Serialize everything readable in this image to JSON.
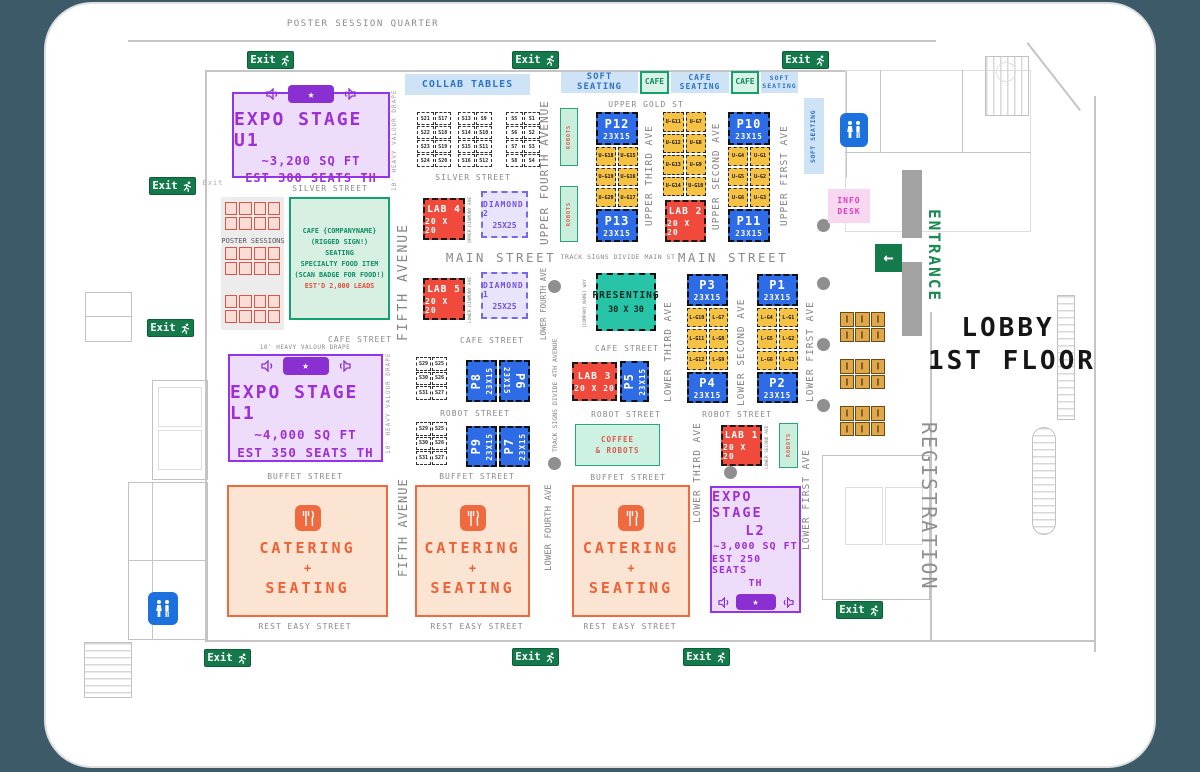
{
  "palette": {
    "page_bg": "#3c5a68",
    "stage_purple": "#9334ea",
    "booth_blue": "#2e6be6",
    "lab_red": "#ef4a3c",
    "gold_booth": "#f5c243",
    "teal": "#28c4a8",
    "exit_green": "#157a4b",
    "soft_blue": "#cfe3f6",
    "cafe_green": "#16a06c",
    "catering_orange": "#f06a40",
    "info_pink": "#f8d7f0",
    "restroom_blue": "#1d71dd"
  },
  "top": {
    "quarter": "POSTER SESSION QUARTER"
  },
  "signs": {
    "exit": "Exit",
    "exit_small": "Exit",
    "arrow_left": "←"
  },
  "zones": {
    "collab": "COLLAB TABLES",
    "soft_seating": "SOFT SEATING",
    "cafe": "CAFE",
    "cafe_seating": "CAFE SEATING",
    "soft_seating_vertical": "SOFT SEATING",
    "poster_sessions": "POSTER SESSIONS",
    "robots": "ROBOTS",
    "coffee_line1": "COFFEE",
    "coffee_line2": "& ROBOTS",
    "info_line1": "INFO",
    "info_line2": "DESK",
    "entrance": "ENTRANCE",
    "registration": "REGISTRATION",
    "lobby_line1": "LOBBY",
    "lobby_line2": "1ST FLOOR"
  },
  "streets": {
    "silver": "SILVER STREET",
    "main": "MAIN STREET",
    "main_note": "TRACK SIGNS DIVIDE MAIN ST",
    "cafe": "CAFE STREET",
    "robot": "ROBOT STREET",
    "buffet": "BUFFET STREET",
    "rest_easy": "REST EASY STREET",
    "upper_gold": "UPPER GOLD ST"
  },
  "avenues": {
    "fifth": "FIFTH AVENUE",
    "upper_fourth": "UPPER FOURTH AVENUE",
    "lower_fourth": "LOWER FOURTH AVE",
    "fourth_note": "TRACK SIGNS DIVIDE 4TH AVENUE",
    "upper_third": "UPPER THIRD AVE",
    "upper_second": "UPPER SECOND AVE",
    "upper_first": "UPPER FIRST AVE",
    "lower_third": "LOWER THIRD AVE",
    "lower_second": "LOWER SECOND AVE",
    "lower_first": "LOWER FIRST AVE",
    "upper_diamond": "UPPER DIAMOND AVE",
    "lower_diamond": "LOWER DIAMOND AVE",
    "company_way": "[COMPANY_NAME] WAY"
  },
  "notes": {
    "drape": "10' HEAVY VALOUR DRAPE"
  },
  "stages": {
    "u1": {
      "title": "EXPO STAGE U1",
      "sqft": "~3,200 SQ FT",
      "seats": "EST 300 SEATS TH"
    },
    "l1": {
      "title": "EXPO STAGE L1",
      "sqft": "~4,000 SQ FT",
      "seats": "EST 350 SEATS TH"
    },
    "l2": {
      "line1": "EXPO STAGE",
      "line2": "L2",
      "sqft": "~3,000 SQ FT",
      "seats1": "EST 250 SEATS",
      "seats2": "TH"
    }
  },
  "cafe_block": {
    "line1": "CAFE {COMPANYNAME}",
    "line2": "(RIGGED SIGN!)",
    "line3": "SEATING",
    "line4": "SPECIALTY FOOD ITEM",
    "line5": "(SCAN BADGE FOR FOOD!)",
    "leads": "EST'D 2,000 LEADS"
  },
  "presenting": {
    "title": "PRESENTING",
    "size": "30 X 30"
  },
  "catering": {
    "line1": "CATERING",
    "plus": "+",
    "line2": "SEATING"
  },
  "labs": {
    "lab1": {
      "name": "LAB 1",
      "size": "20 X 20"
    },
    "lab2": {
      "name": "LAB 2",
      "size": "20 X 20"
    },
    "lab3": {
      "name": "LAB 3",
      "size": "20 X 20"
    },
    "lab4": {
      "name": "LAB 4",
      "size": "20 X 20"
    },
    "lab5": {
      "name": "LAB 5",
      "size": "20 X 20"
    }
  },
  "diamonds": {
    "d1": {
      "name": "DIAMOND 1",
      "size": "25X25"
    },
    "d2": {
      "name": "DIAMOND 2",
      "size": "25X25"
    }
  },
  "p_booths": {
    "p1": {
      "name": "P1",
      "size": "23X15"
    },
    "p2": {
      "name": "P2",
      "size": "23X15"
    },
    "p3": {
      "name": "P3",
      "size": "23X15"
    },
    "p4": {
      "name": "P4",
      "size": "23X15"
    },
    "p5": {
      "name": "P5",
      "size": "23X15"
    },
    "p6": {
      "name": "P6",
      "size": "23X15"
    },
    "p7": {
      "name": "P7",
      "size": "23X15"
    },
    "p8": {
      "name": "P8",
      "size": "23X15"
    },
    "p9": {
      "name": "P9",
      "size": "23X15"
    },
    "p10": {
      "name": "P10",
      "size": "23X15"
    },
    "p11": {
      "name": "P11",
      "size": "23X15"
    },
    "p12": {
      "name": "P12",
      "size": "23X15"
    },
    "p13": {
      "name": "P13",
      "size": "23X15"
    }
  },
  "g_booths": {
    "upper_left": [
      "U-G18",
      "U-G15",
      "U-G19",
      "U-G16",
      "U-G20",
      "U-G17"
    ],
    "upper_mid": [
      "U-G11",
      "U-G7",
      "U-G12",
      "U-G8",
      "U-G13",
      "U-G9",
      "U-G14",
      "U-G10"
    ],
    "upper_right": [
      "U-G4",
      "U-G1",
      "U-G5",
      "U-G2",
      "U-G6",
      "U-G3"
    ],
    "lower_left": [
      "L-G10",
      "L-G7",
      "L-G11",
      "L-G8",
      "L-G12",
      "L-G9"
    ],
    "lower_right": [
      "L-G4",
      "L-G1",
      "L-G5",
      "L-G2",
      "L-G6",
      "L-G3"
    ]
  },
  "s_booths": {
    "silver_a": [
      "S21",
      "S17",
      "S22",
      "S18",
      "S23",
      "S19",
      "S24",
      "S20"
    ],
    "silver_b": [
      "S13",
      "S9",
      "S14",
      "S10",
      "S15",
      "S11",
      "S16",
      "S12"
    ],
    "silver_c": [
      "S5",
      "S1",
      "S6",
      "S2",
      "S7",
      "S3",
      "S8",
      "S4"
    ],
    "robot_a": [
      "S29",
      "S25",
      "S30",
      "S26",
      "S31",
      "S27"
    ],
    "robot_b": [
      "S29",
      "S25",
      "S30",
      "S26",
      "S31",
      "S27"
    ]
  }
}
